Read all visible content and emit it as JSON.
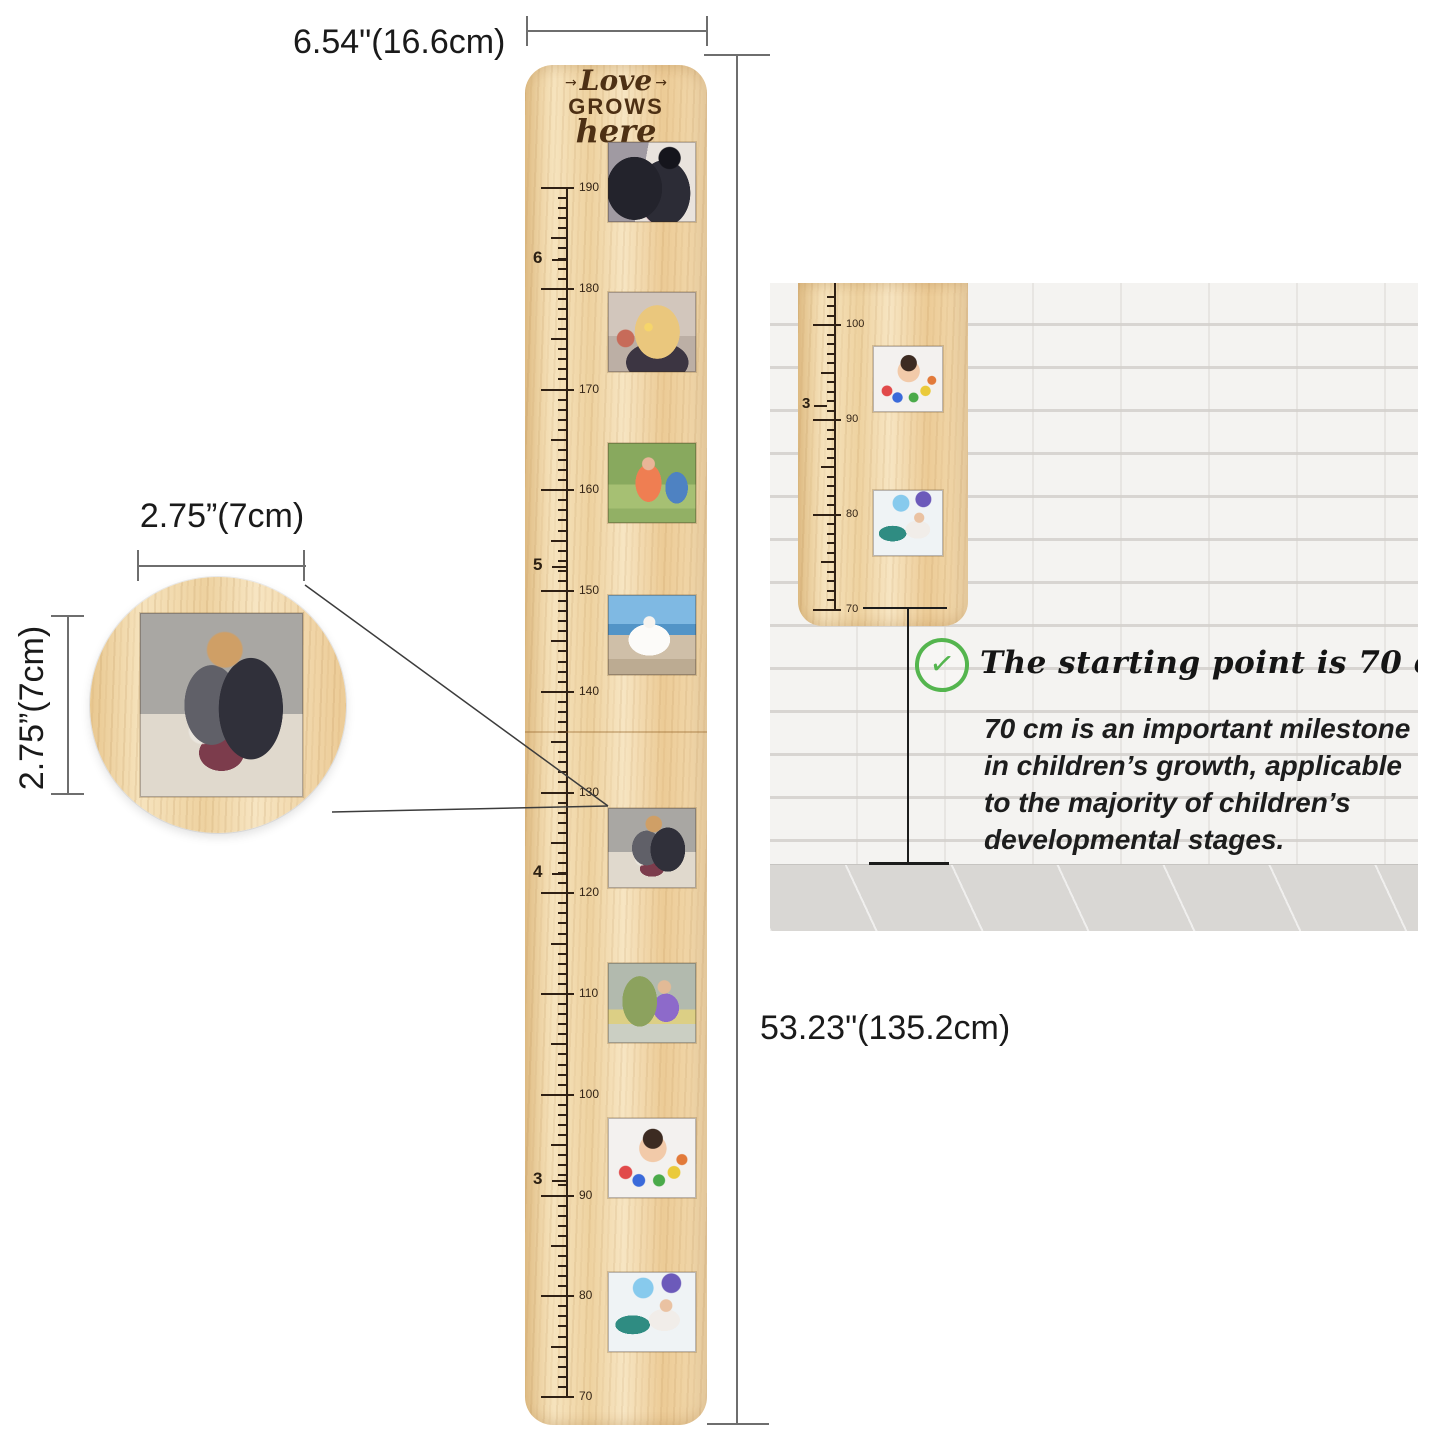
{
  "dimensions": {
    "width_label": "6.54\"(16.6cm)",
    "height_label": "53.23\"(135.2cm)",
    "inset_width_label": "2.75”(7cm)",
    "inset_height_label": "2.75”(7cm)"
  },
  "ruler": {
    "engraving": {
      "arrow_left": "→",
      "line1": "Love",
      "line2": "GROWS",
      "line3": "here",
      "arrow_right": "→"
    },
    "scale": {
      "cm_top": 190,
      "cm_bottom": 70,
      "major_labels": [
        190,
        180,
        170,
        160,
        150,
        140,
        130,
        120,
        110,
        100,
        90,
        80,
        70
      ],
      "feet_labels": [
        {
          "label": "6",
          "cm": 182.88
        },
        {
          "label": "5",
          "cm": 152.4
        },
        {
          "label": "4",
          "cm": 121.92
        },
        {
          "label": "3",
          "cm": 91.44
        }
      ]
    },
    "photos": [
      {
        "name": "graduation-photo",
        "alt": "graduation couple"
      },
      {
        "name": "birthday-candles-photo",
        "alt": "woman blowing out candles"
      },
      {
        "name": "marathon-photo",
        "alt": "woman finishing a race"
      },
      {
        "name": "travel-vista-photo",
        "alt": "woman with open arms over a city view"
      },
      {
        "name": "backpack-girl-photo",
        "alt": "girl with backpack and soccer ball"
      },
      {
        "name": "school-walk-photo",
        "alt": "child with purple backpack walking with parent"
      },
      {
        "name": "painted-hands-photo",
        "alt": "child with colorful painted hands"
      },
      {
        "name": "birthday-party-photo",
        "alt": "toddler at birthday party with balloons"
      }
    ]
  },
  "inset": {
    "photo": {
      "name": "backpack-girl-photo",
      "alt": "girl with backpack and soccer ball"
    }
  },
  "panel": {
    "headline": "The starting point is 70 cm.",
    "body_lines": [
      "70 cm is an important milestone",
      "in children’s growth, applicable",
      "to the majority of children’s",
      "developmental stages."
    ],
    "check_glyph": "✓",
    "mini_scale": {
      "cm_top": 103,
      "cm_bottom": 70,
      "major_labels": [
        100,
        90,
        80,
        70
      ],
      "feet_labels": [
        {
          "label": "3",
          "cm": 91.44
        }
      ]
    },
    "photos": [
      {
        "name": "painted-hands-photo",
        "alt": "child with colorful painted hands"
      },
      {
        "name": "birthday-party-photo",
        "alt": "toddler at birthday party with balloons"
      }
    ]
  },
  "colors": {
    "wood": "#efd2a0",
    "engraving": "#4d3014",
    "tick": "#2f2014",
    "dimension_line": "#6e6e6e",
    "check_green": "#54b54e",
    "brick_wall": "#f4f3f1",
    "floor": "#d9d7d4",
    "text": "#1a1a1a"
  }
}
